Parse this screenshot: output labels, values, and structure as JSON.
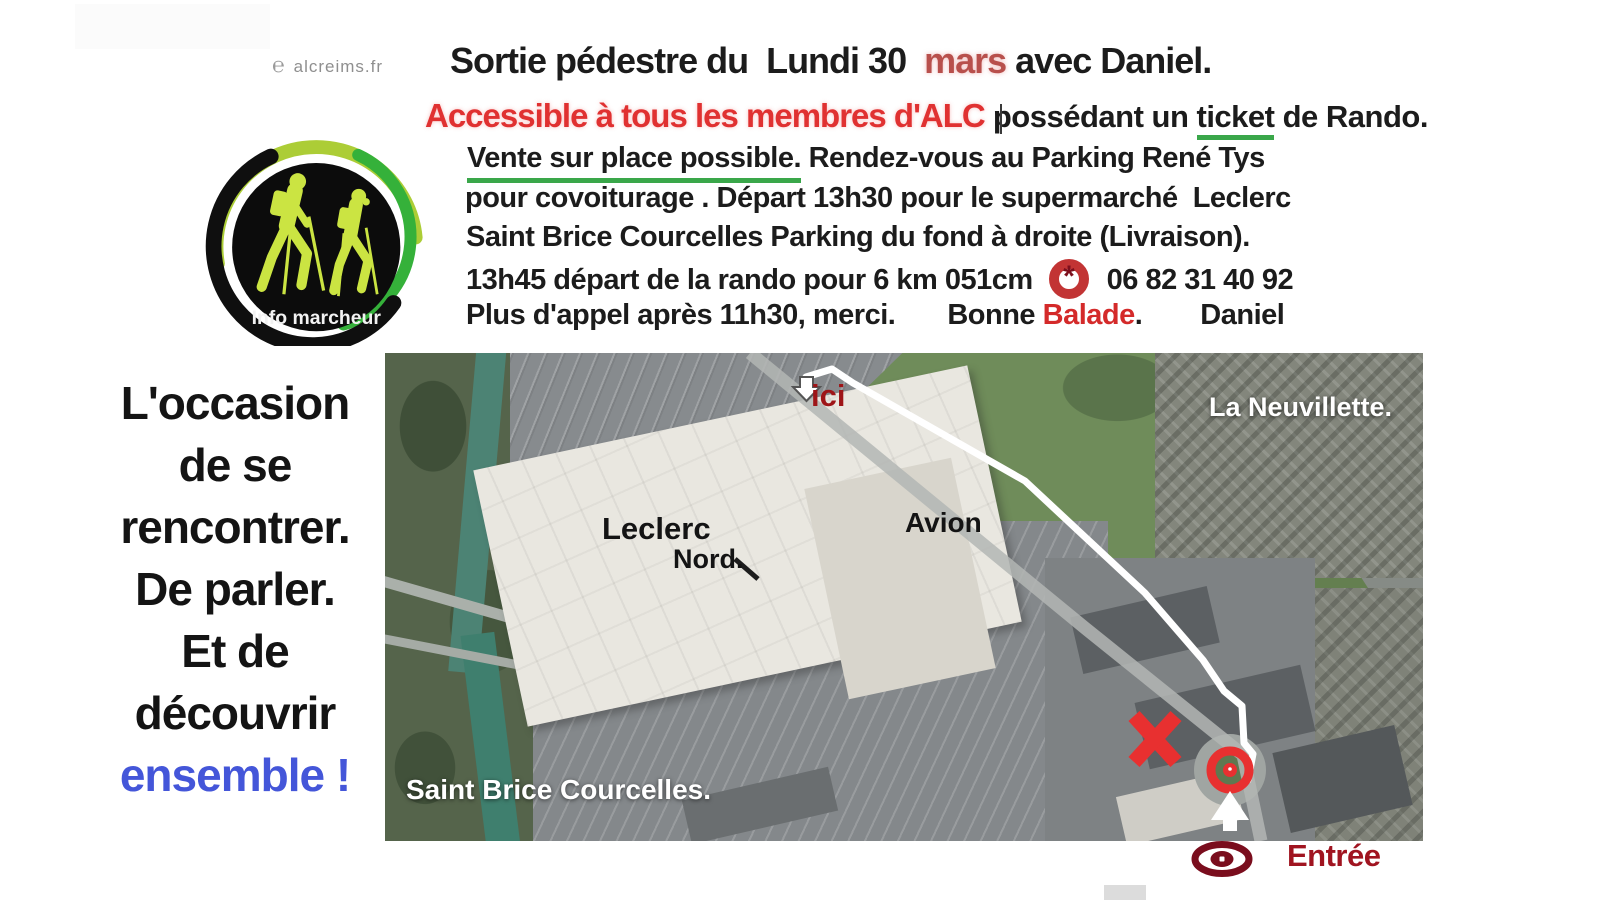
{
  "flyer": {
    "logo": {
      "site_icon": "℮",
      "site": "alcreims.fr",
      "caption": "Info marcheur"
    },
    "title": {
      "part1": "Sortie pédestre du  Lundi 30  ",
      "highlight": "mars",
      "part2": " avec Daniel."
    },
    "line2": {
      "red": "Accessible à tous les membres d'ALC",
      "mid": " possédant un ",
      "underlined": "ticket",
      "end": " de Rando."
    },
    "line3": {
      "underlined": "Vente sur place possible.",
      "rest": " Rendez-vous au Parking René Tys"
    },
    "line4": "pour covoiturage . Départ 13h30 pour le supermarché  Leclerc",
    "line5": "Saint Brice Courcelles Parking du fond à droite (Livraison).",
    "line6": {
      "pre": "13h45 départ de la rando pour 6 km 051cm",
      "phone_icon": "*",
      "phone": "06 82 31 40 92"
    },
    "line7": {
      "pre": "Plus d'appel après 11h30, merci.",
      "bonne": "Bonne ",
      "balade": "Balade",
      "dot": ".",
      "signature": "Daniel"
    }
  },
  "slogan": {
    "lines": [
      "L'occasion",
      "de se",
      "rencontrer.",
      "De parler.",
      "Et de",
      "découvrir"
    ],
    "highlight": "ensemble !"
  },
  "map": {
    "labels": {
      "ici": "ici",
      "la_neuvillette": "La Neuvillette.",
      "leclerc": "Leclerc",
      "nord": "Nord.",
      "avion": "Avion",
      "saint_brice": "Saint Brice Courcelles.",
      "entree": "Entrée"
    },
    "colors": {
      "marker_red": "#e83030",
      "label_dark_red": "#9e1518",
      "entree_red": "#a01420",
      "eye_maroon": "#7a0d1d",
      "path_white": "#ffffff",
      "underline_green": "#3aa74a",
      "accent_red": "#e03131",
      "slogan_blue": "#4456d9"
    }
  }
}
